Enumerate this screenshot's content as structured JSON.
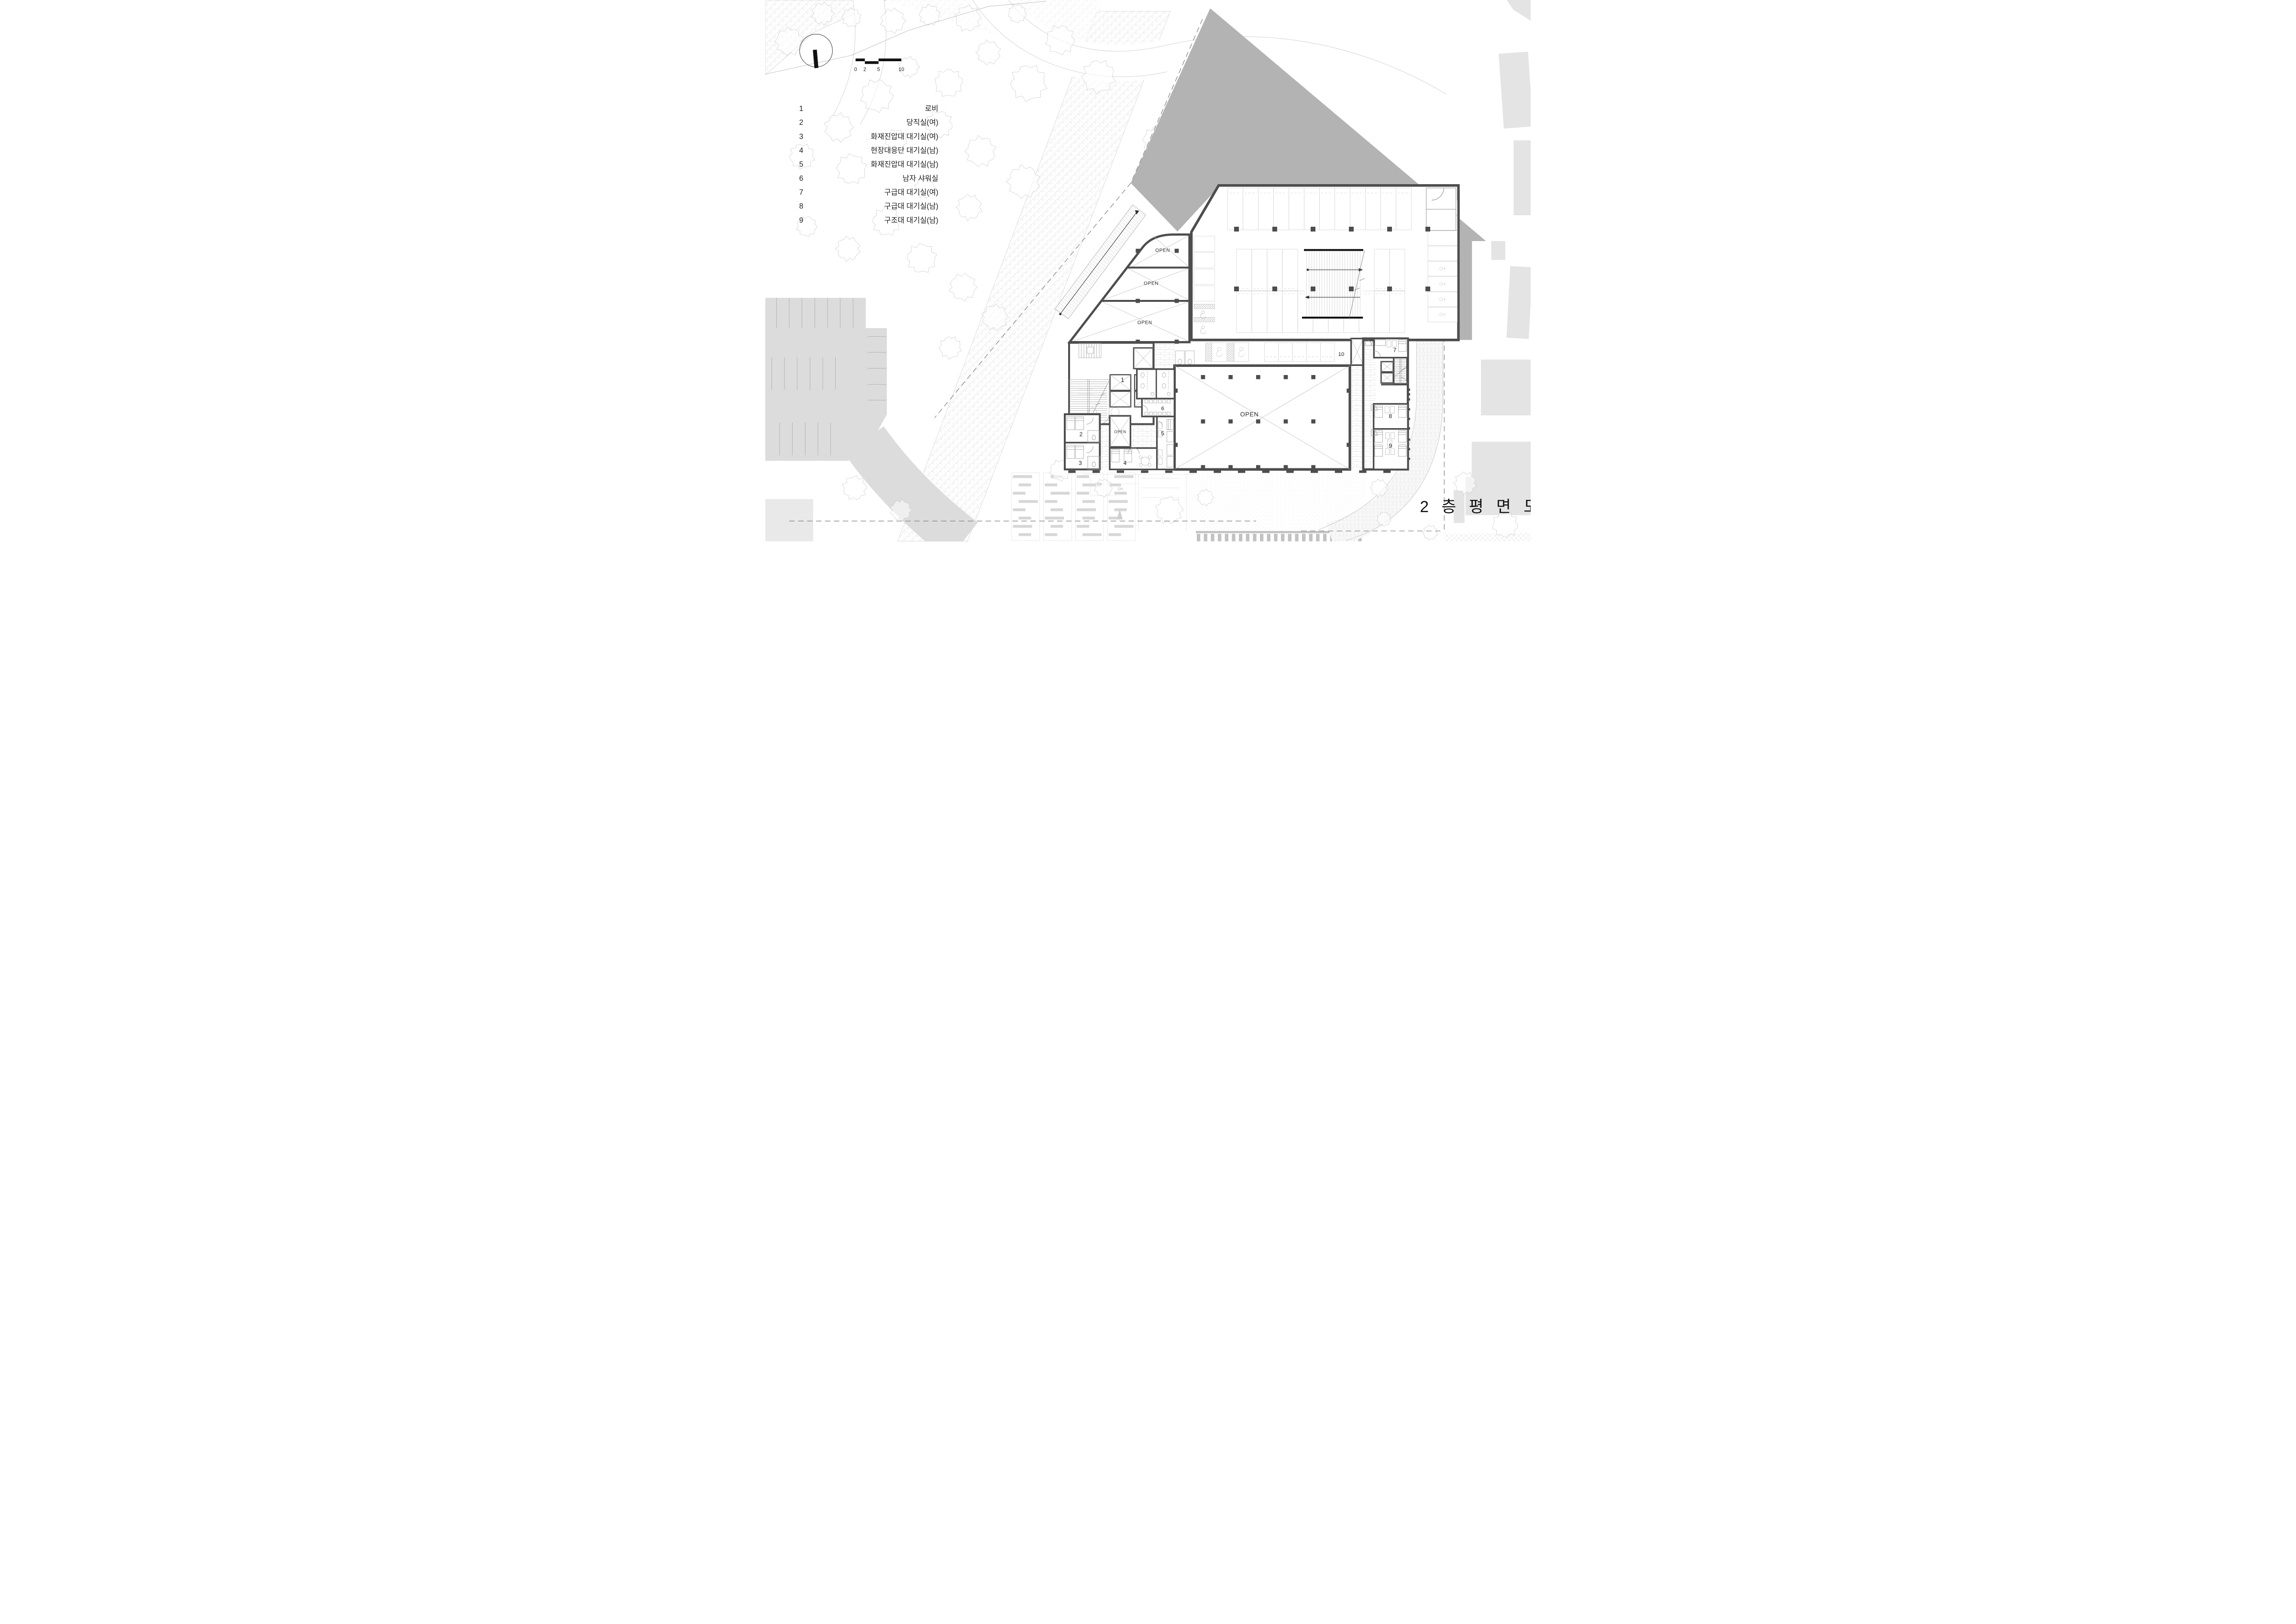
{
  "drawing": {
    "title": "2 층 평 면 도",
    "type_note": "second floor plan"
  },
  "scale_bar": {
    "ticks": [
      "0",
      "2",
      "5",
      "10"
    ]
  },
  "legend": {
    "items": [
      {
        "no": "1",
        "label": "로비"
      },
      {
        "no": "2",
        "label": "당직실(여)"
      },
      {
        "no": "3",
        "label": "화재진압대 대기실(여)"
      },
      {
        "no": "4",
        "label": "현장대응단 대기실(남)"
      },
      {
        "no": "5",
        "label": "화재진압대 대기실(남)"
      },
      {
        "no": "6",
        "label": "남자 샤워실"
      },
      {
        "no": "7",
        "label": "구급대 대기실(여)"
      },
      {
        "no": "8",
        "label": "구급대 대기실(남)"
      },
      {
        "no": "9",
        "label": "구조대 대기실(남)"
      }
    ]
  },
  "plan": {
    "open_label": "OPEN",
    "dn_label": "DN",
    "room_numbers": [
      "1",
      "2",
      "3",
      "4",
      "5",
      "6",
      "7",
      "8",
      "9",
      "10"
    ]
  },
  "colors": {
    "wall": "#4d4d4d",
    "shadow": "#b3b3b3",
    "road": "#dcdcdc",
    "footprint": "#e4e4e4",
    "thin_line": "#9a9a9a",
    "light_line": "#c9c9c9"
  }
}
